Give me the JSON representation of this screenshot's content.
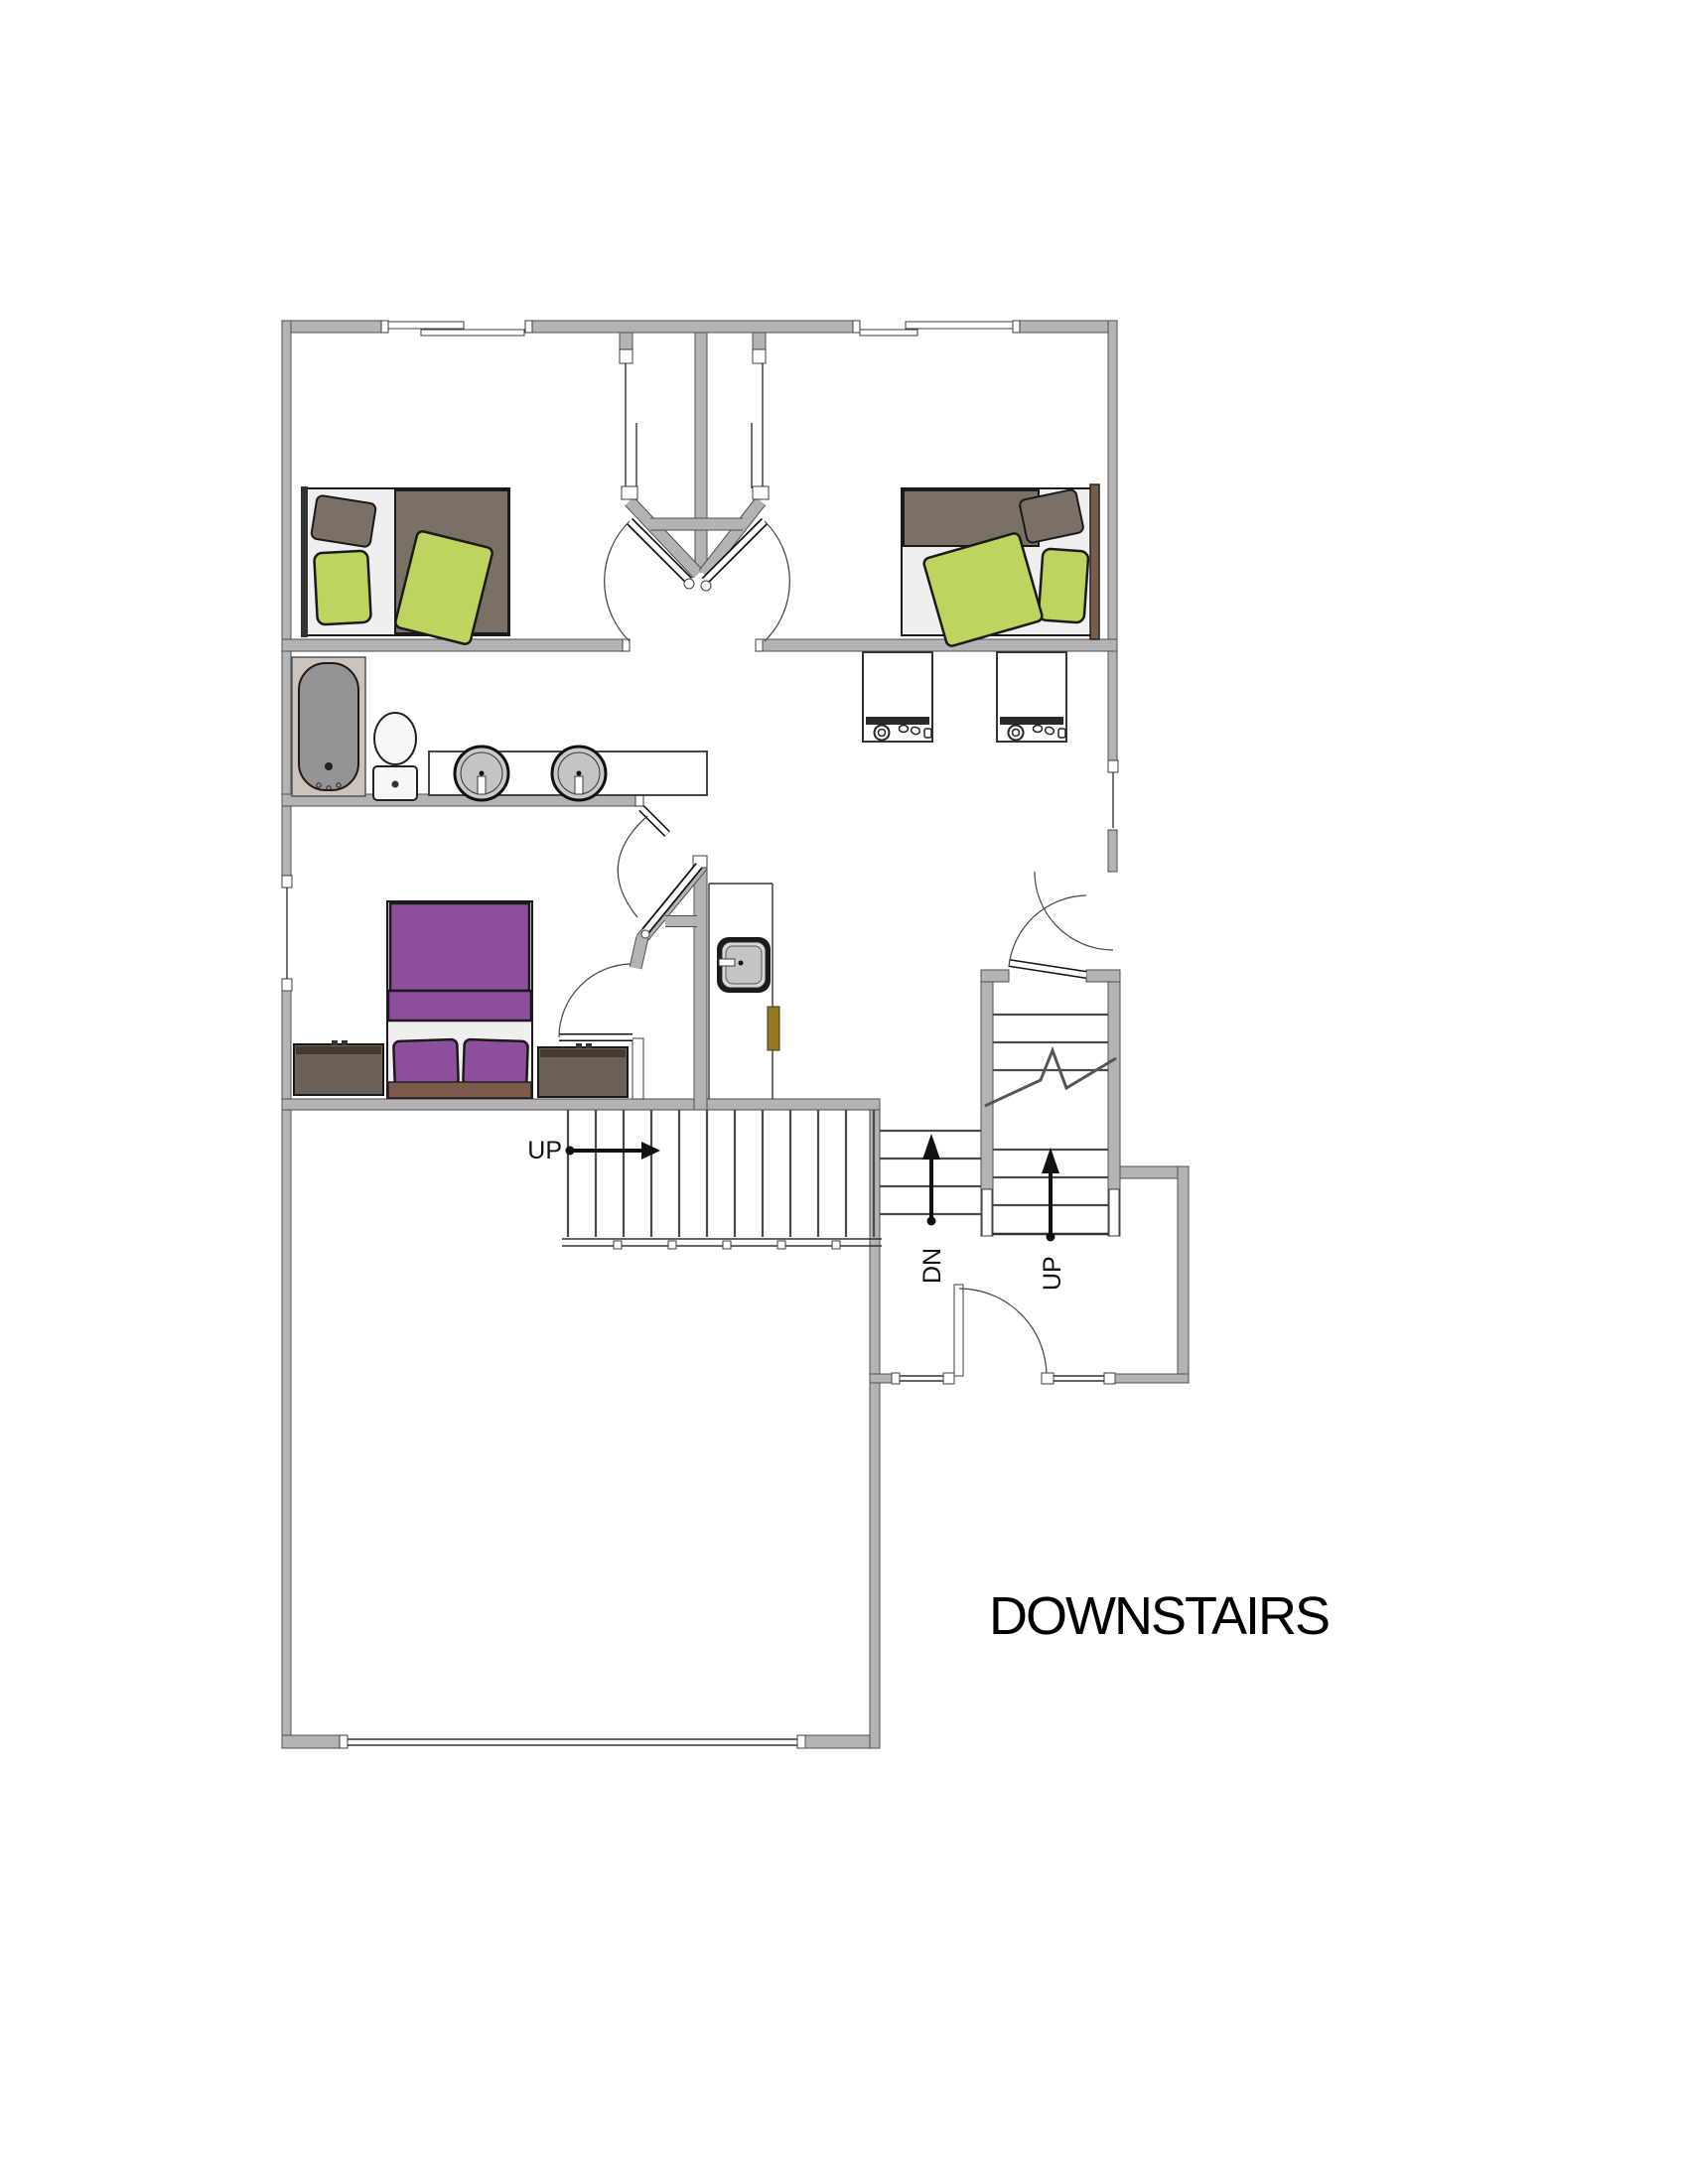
{
  "floor_label": "DOWNSTAIRS",
  "stairs": {
    "garage_up_label": "UP",
    "entry_up_label": "UP",
    "entry_down_label": "DN"
  },
  "colors": {
    "wall": "#b5b2b2",
    "wallStroke": "#4f4f4f",
    "bedGreen": "#bdd45f",
    "duvetGray": "#7b7066",
    "headboardBrown": "#7a5c48",
    "purple": "#8d4f9c",
    "dresser": "#6d6057",
    "dresserTop": "#443a31",
    "tubSurround": "#cdc3ba",
    "tubGray": "#949494",
    "sinkGray": "#c9c9c9",
    "oliveDoor": "#97781c"
  }
}
